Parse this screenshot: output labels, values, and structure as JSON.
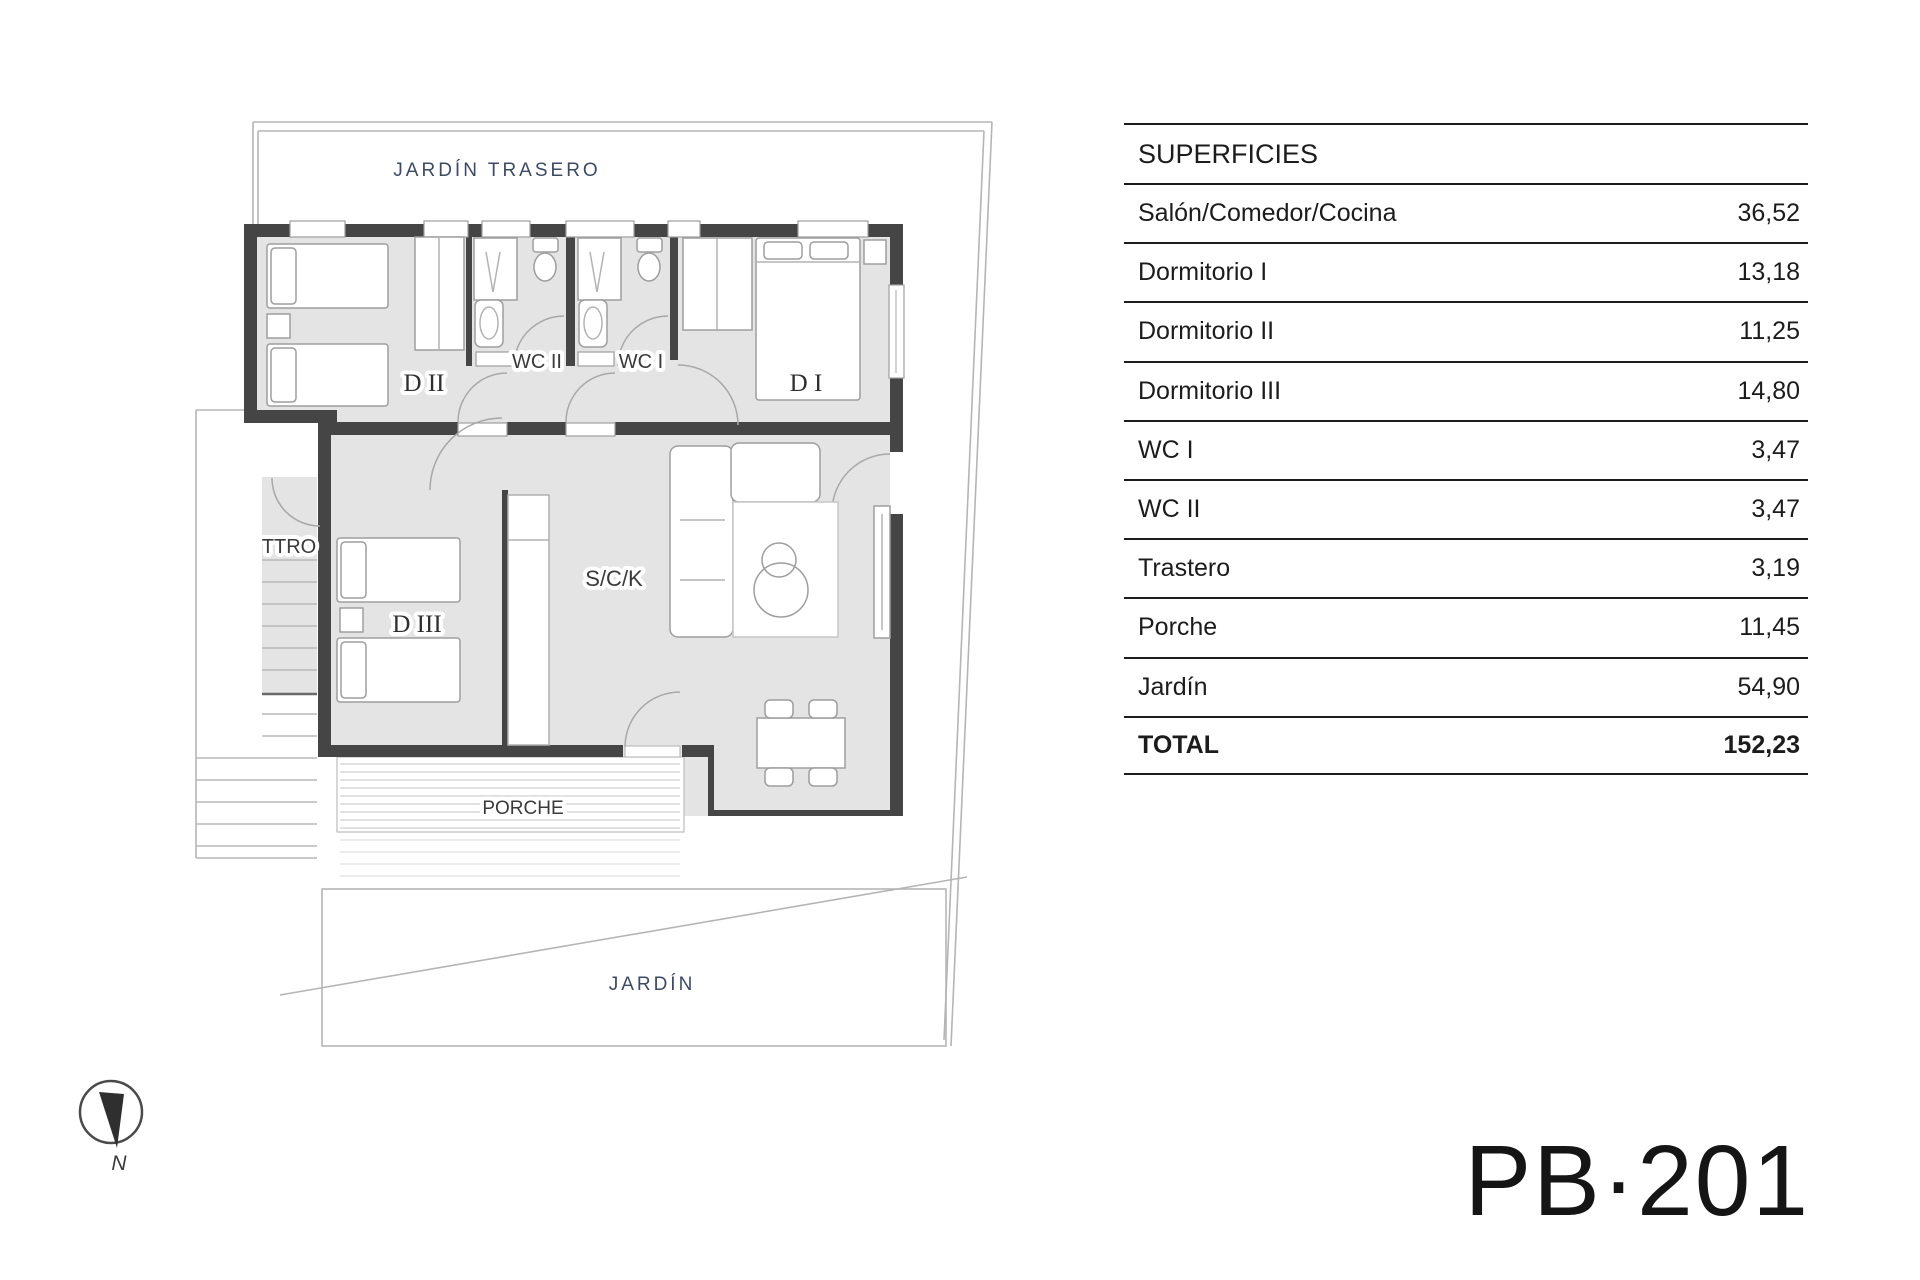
{
  "floor_plan": {
    "labels": {
      "garden_back": "JARDÍN TRASERO",
      "bedroom2": "D II",
      "wc2": "WC II",
      "wc1": "WC I",
      "bedroom1": "D I",
      "storage": "TTRO",
      "bedroom3": "D III",
      "living": "S/C/K",
      "porch": "PORCHE",
      "garden": "JARDÍN",
      "compass_north": "N"
    },
    "colors": {
      "room_fill": "#e4e4e4",
      "wall": "#454545",
      "plot_line": "#b5b5b5",
      "furniture_line": "#9e9e9e",
      "label_dark": "#3a3a3a",
      "label_blue": "#3b4a68"
    }
  },
  "surfaces_table": {
    "header": "SUPERFICIES",
    "rows": [
      {
        "label": "Salón/Comedor/Cocina",
        "value": "36,52"
      },
      {
        "label": "Dormitorio I",
        "value": "13,18"
      },
      {
        "label": "Dormitorio II",
        "value": "11,25"
      },
      {
        "label": "Dormitorio III",
        "value": "14,80"
      },
      {
        "label": "WC I",
        "value": "3,47"
      },
      {
        "label": "WC II",
        "value": "3,47"
      },
      {
        "label": "Trastero",
        "value": "3,19"
      },
      {
        "label": "Porche",
        "value": "11,45"
      },
      {
        "label": "Jardín",
        "value": "54,90"
      }
    ],
    "total_row": {
      "label": "TOTAL",
      "value": "152,23"
    }
  },
  "plan_code": "PB·201"
}
